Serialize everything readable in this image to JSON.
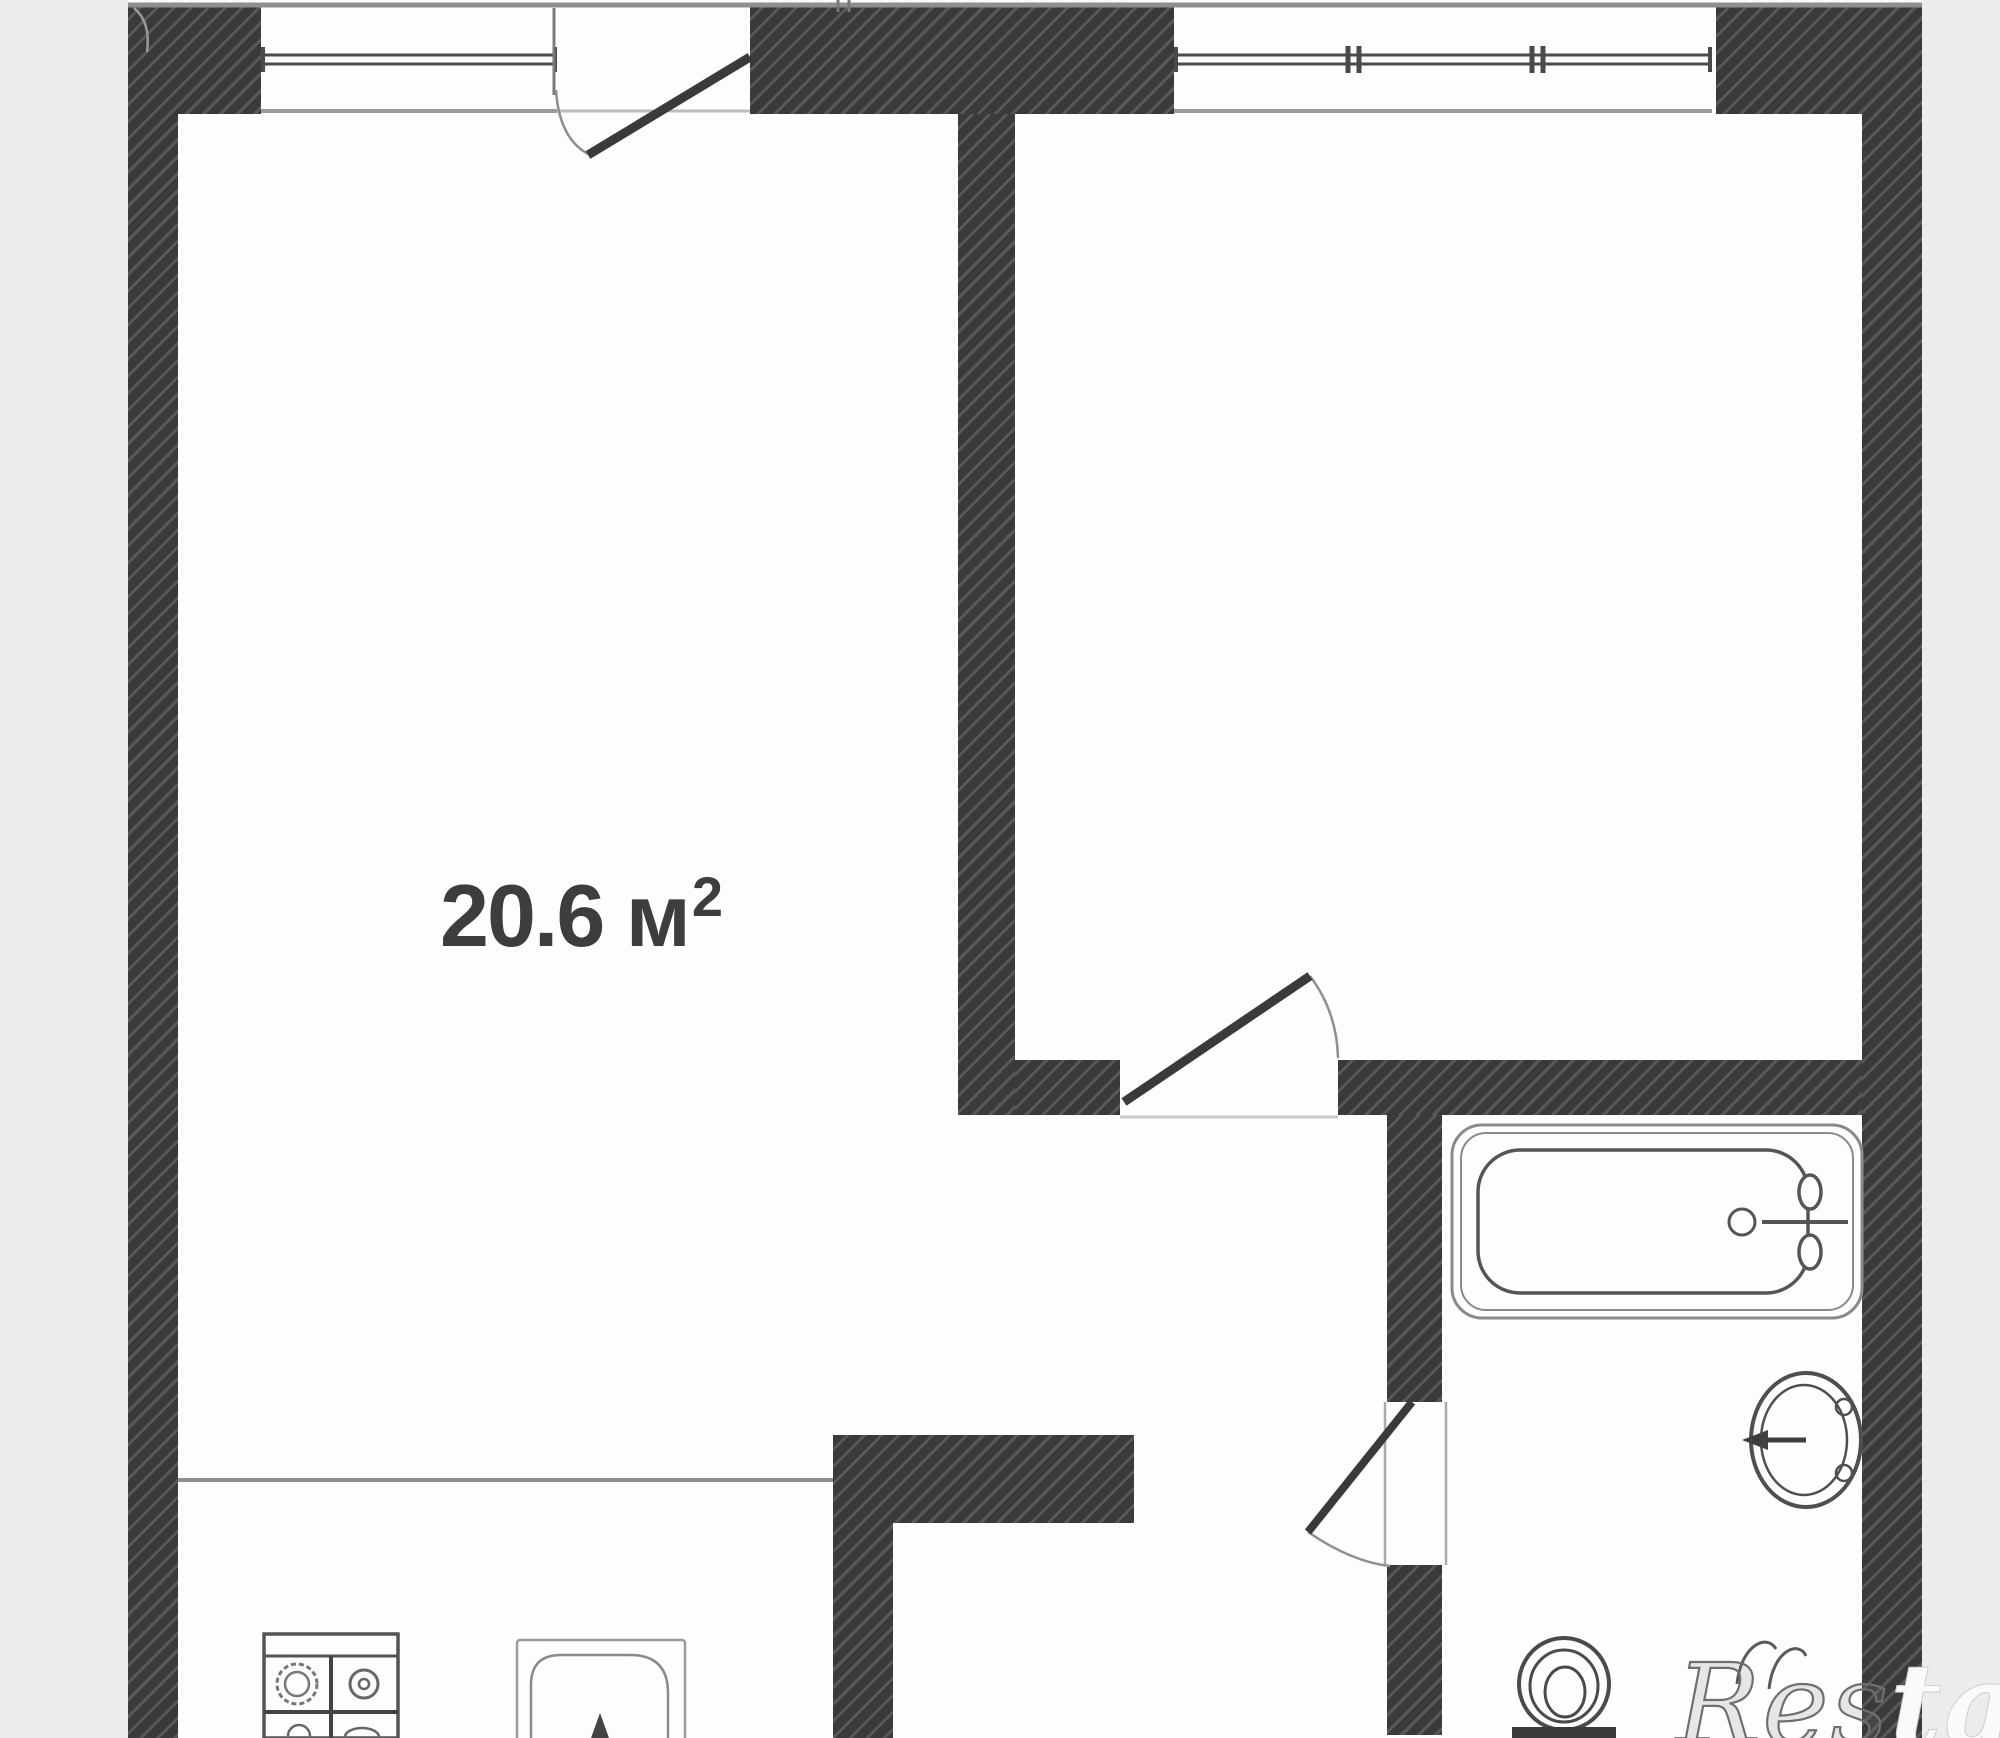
{
  "page": {
    "type": "apartment-floor-plan"
  },
  "rooms": {
    "living": {
      "area_text": "20.6 м",
      "area_sup": "2"
    }
  },
  "watermark": {
    "outline_part": "Res",
    "solid_part": "tate"
  },
  "colors": {
    "background": "#ececec",
    "plan": "#fdfdfd",
    "wall": "#3a3a3a",
    "wall_hatch": "#585858",
    "line": "#8f8f8f",
    "glass": "#4a4a4a",
    "fixture": "#555555",
    "label": "#3d3d3d"
  },
  "fixtures": {
    "bathtub": "bathtub-icon",
    "washbasin": "washbasin-icon",
    "toilet": "toilet-icon",
    "stove": "stove-4-burner-icon",
    "kitchen_sink": "kitchen-sink-icon"
  }
}
